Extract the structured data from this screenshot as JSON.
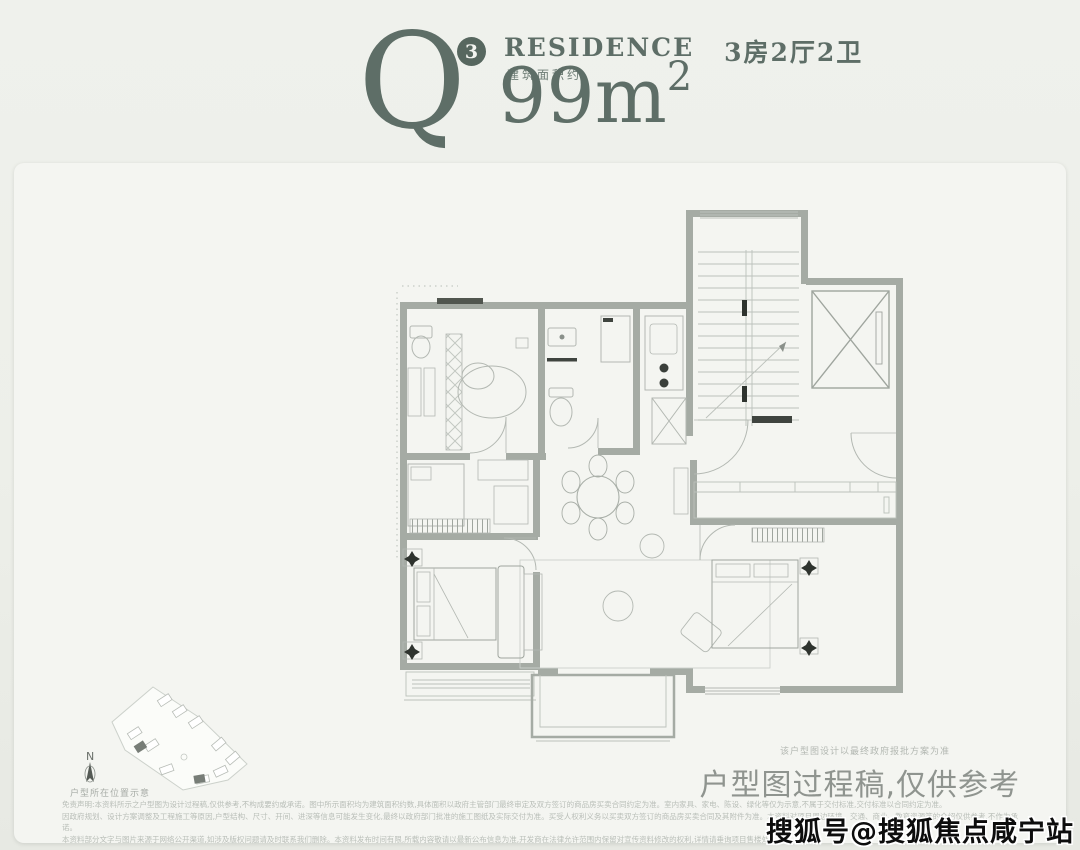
{
  "header": {
    "plan_letter": "Q",
    "plan_sup": "3",
    "residence_label": "RESIDENCE",
    "layout_label": "3房2厅2卫",
    "area_prefix": "建筑面积约",
    "area_main": "99m",
    "area_sup": "2"
  },
  "siteplan": {
    "north_label": "N",
    "caption": "户型所在位置示意"
  },
  "footer": {
    "process_note_small": "该户型图设计以最终政府报批方案为准",
    "process_note": "户型图过程稿,仅供参考",
    "disclaimer_lines": [
      "免责声明:本资料所示之户型图为设计过程稿,仅供参考,不构成要约或承诺。图中所示面积均为建筑面积约数,具体面积以政府主管部门最终审定及双方签订的商品房买卖合同约定为准。室内家具、家电、陈设、绿化等仅为示意,不属于交付标准,交付标准以合同约定为准。",
      "因政府规划、设计方案调整及工程施工等原因,户型结构、尺寸、开间、进深等信息可能发生变化,最终以政府部门批准的施工图纸及实际交付为准。买受人权利义务以买卖双方签订的商品房买卖合同及其附件为准。本资料对项目周边环境、交通、商业、教育资源等的介绍仅供参考,不作为承诺。",
      "本资料部分文字与图片来源于网络公开渠道,如涉及版权问题请及时联系我们删除。本资料发布时间有限,所载内容敬请以最新公布信息为准,开发商在法律允许范围内保留对宣传资料修改的权利,详情请垂询项目售楼处。"
    ]
  },
  "watermark": "搜狐号@搜狐焦点咸宁站",
  "colors": {
    "accent": "#5e6e67",
    "badge": "#57675f",
    "wall": "#a5aba4",
    "caption": "#8f948f",
    "background": "#eff1ec"
  }
}
